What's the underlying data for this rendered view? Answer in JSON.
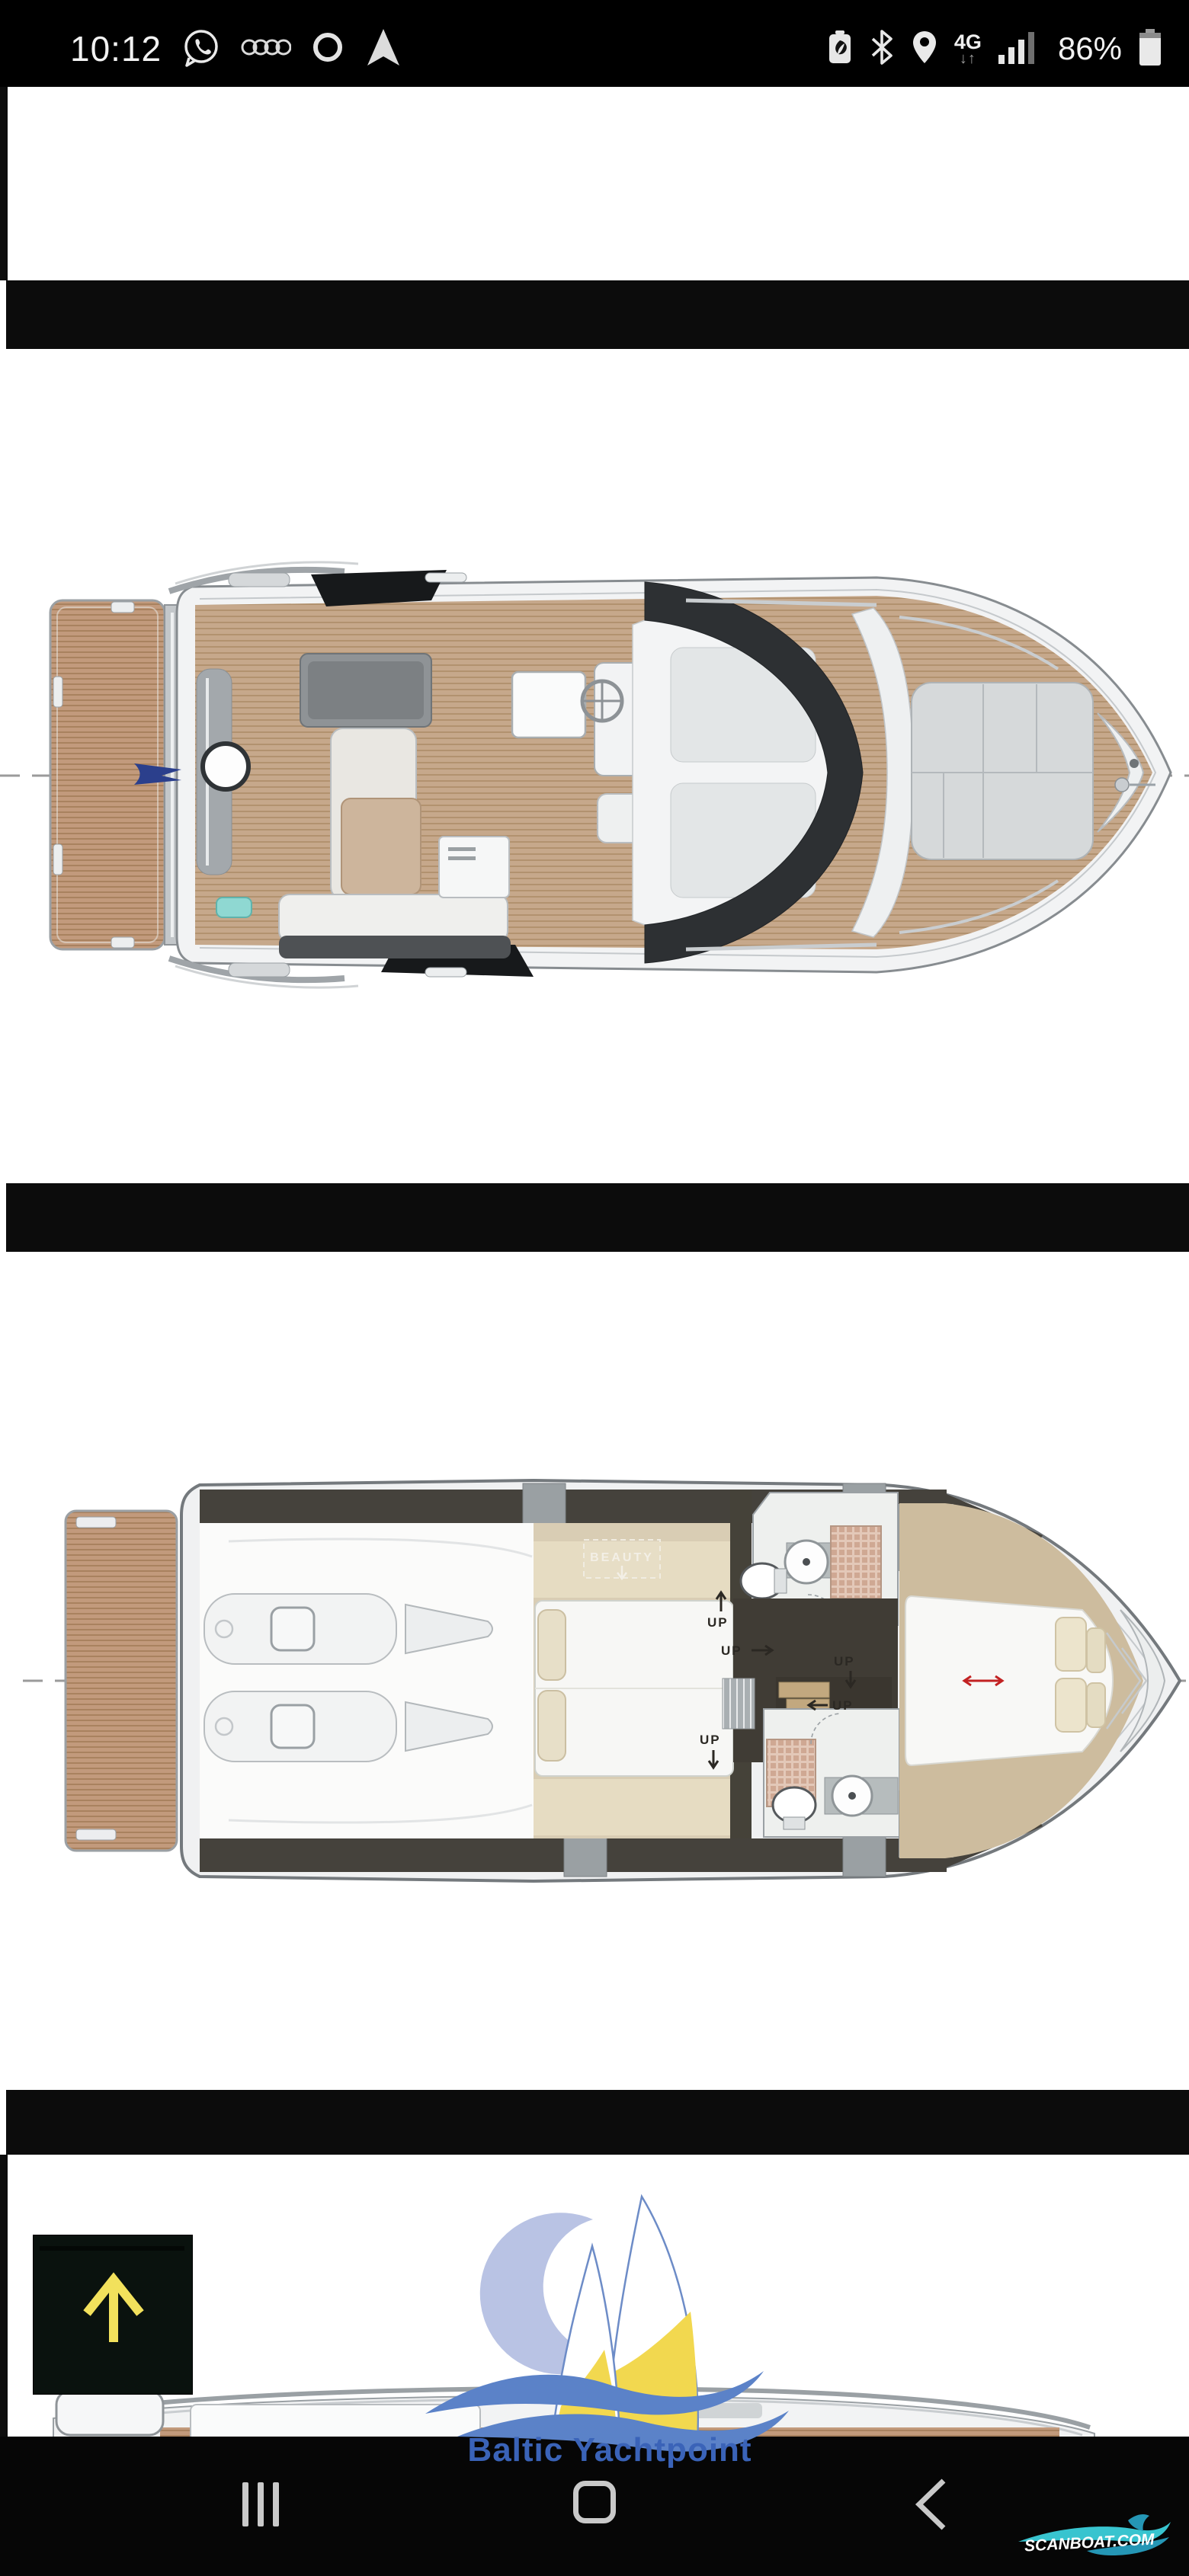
{
  "status_bar": {
    "time": "10:12",
    "network_label": "4G",
    "battery_percent": "86%",
    "left_icons": [
      "whatsapp-icon",
      "audi-rings-icon",
      "circle-app-icon",
      "android-auto-icon"
    ],
    "right_icons": [
      "battery-saver-icon",
      "bluetooth-icon",
      "location-icon",
      "network-4g-icon",
      "signal-bars-icon",
      "battery-icon"
    ]
  },
  "plans": {
    "deck": {
      "title": "deck-top-view-plan"
    },
    "lower": {
      "title": "lower-deck-floor-plan",
      "beauty_label": "BEAUTY",
      "up_label": "UP"
    },
    "flybridge": {
      "title": "flybridge-plan-partial",
      "up_label": "UP"
    }
  },
  "dealer_logo": {
    "text": "Baltic Yachtpoint",
    "colors": {
      "text_blue": "#3a63b8",
      "wave_blue": "#5b82c8",
      "sail_yellow": "#f2d84f",
      "crescent": "#b9c3e4"
    }
  },
  "watermark": {
    "text": "SCANBOAT.COM",
    "wave_color": "#38c4cf"
  },
  "nav_bar": {
    "buttons": [
      "recents",
      "home",
      "back"
    ]
  },
  "scroll_button": {
    "icon": "arrow-up-icon",
    "background": "#0a120e",
    "arrow_color": "#f2e15c"
  },
  "theme": {
    "divider_band": "#0c0c0c",
    "status_bar_bg": "#000000",
    "wood": "#c29a7c",
    "hull": "#f2f3f4"
  }
}
